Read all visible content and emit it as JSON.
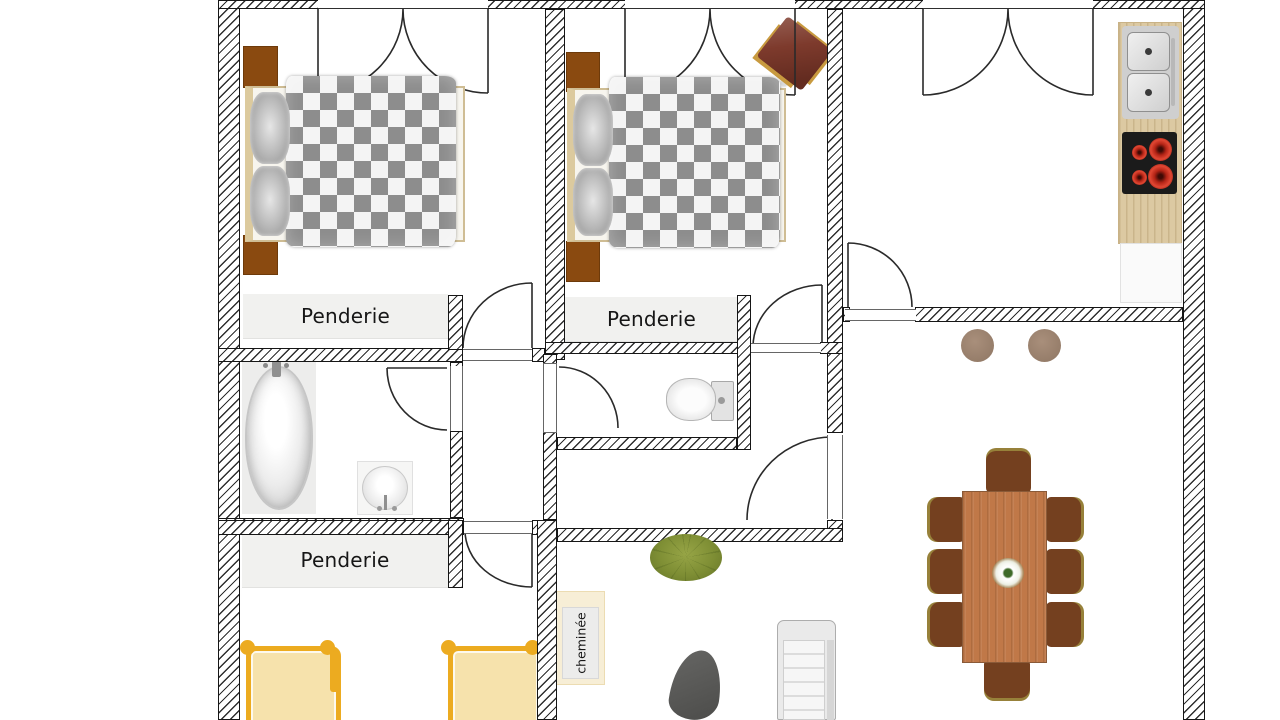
{
  "floorplan": {
    "labels": {
      "closet_bedroom1": "Penderie",
      "closet_bedroom2": "Penderie",
      "closet_kids_room": "Penderie",
      "fireplace": "cheminée"
    },
    "colors": {
      "wall_hatch_line": "#2e2e2e",
      "closet_fill": "#f1f1ef",
      "nightstand_brown": "#8a4a10",
      "duvet_check_gray": "#8d8d8d",
      "bed_frame_beige": "#dcca9e",
      "kids_bed_gold": "#ecab20",
      "kids_bed_fill": "#f6e2ac",
      "table_wood": "#c07848",
      "dining_chair_brown": "#74401f",
      "chair_trim_olive": "#97813a",
      "counter_wood": "#dcc9a2",
      "stove_black": "#1b1b1b",
      "burner_red": "#c62b1c",
      "plant_green": "#7e8e34",
      "accent_chair_red": "#7d3a2c",
      "stool_taupe": "#9d8674",
      "lounge_chair_gray": "#565654"
    },
    "furniture_icons": [
      "double-bed",
      "nightstand",
      "accent-chair",
      "kitchen-sink",
      "stove",
      "kitchen-counter",
      "kitchen-cabinet",
      "dining-table",
      "dining-chair",
      "stool",
      "bathtub",
      "washbasin",
      "toilet",
      "single-bed",
      "fireplace",
      "potted-plant",
      "lounge-chair",
      "sofa",
      "flower-centerpiece"
    ]
  }
}
